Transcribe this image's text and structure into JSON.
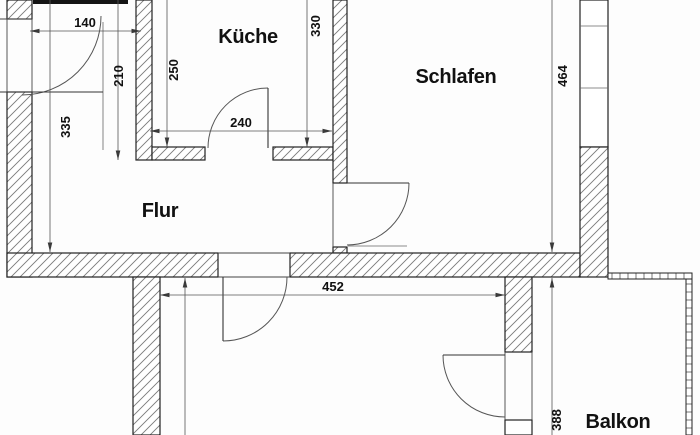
{
  "plan": {
    "rooms": {
      "kitchen": "Küche",
      "bedroom": "Schlafen",
      "hallway": "Flur",
      "balcony": "Balkon"
    },
    "dimensions_cm": {
      "entry_width": "140",
      "entry_depth": "210",
      "hallway_left": "335",
      "kitchen_left": "250",
      "kitchen_right": "330",
      "kitchen_width": "240",
      "living_width": "452",
      "bedroom_depth": "464",
      "balcony_depth": "388"
    },
    "colors": {
      "background": "#ffffff",
      "wall_line": "#222222",
      "hatch_line": "#7a7a7a",
      "dimension_line": "#555555",
      "text": "#111111"
    }
  }
}
